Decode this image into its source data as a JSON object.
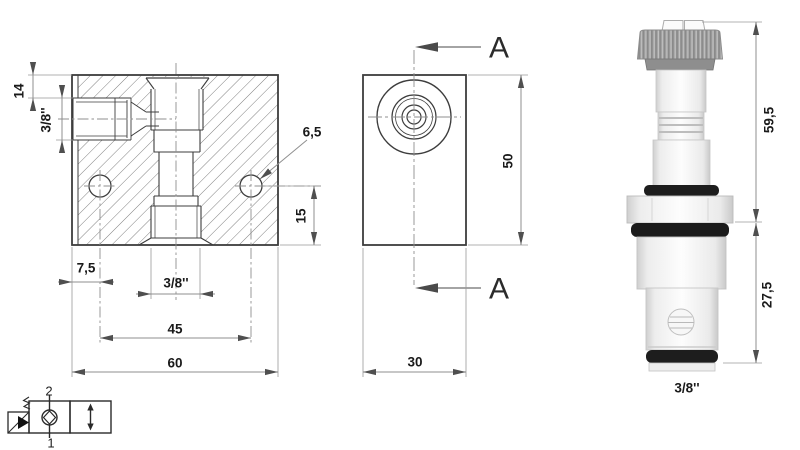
{
  "drawing_title": "hydraulic cartridge valve 2/2 with mounting block - dimensional drawing",
  "front_view": {
    "d14": "14",
    "d38_port": "3/8''",
    "d65": "6,5",
    "d15": "15",
    "d75": "7,5",
    "d38_bottom": "3/8''",
    "d45": "45",
    "d60": "60"
  },
  "side_view": {
    "section_label_top": "A",
    "section_label_bottom": "A",
    "d50": "50",
    "d30": "30"
  },
  "photo": {
    "d595": "59,5",
    "d275": "27,5",
    "d38": "3/8''"
  },
  "symbol": {
    "port_top": "2",
    "port_bottom": "1"
  },
  "colors": {
    "background": "#ffffff",
    "drawing_line": "#3d3d3d",
    "dimension_line": "#8f8f8f",
    "arrow": "#4f4f4f",
    "text": "#1a1a1a",
    "oring_black": "#1d1d1d",
    "knurl_gray": "#a0a0a0"
  }
}
